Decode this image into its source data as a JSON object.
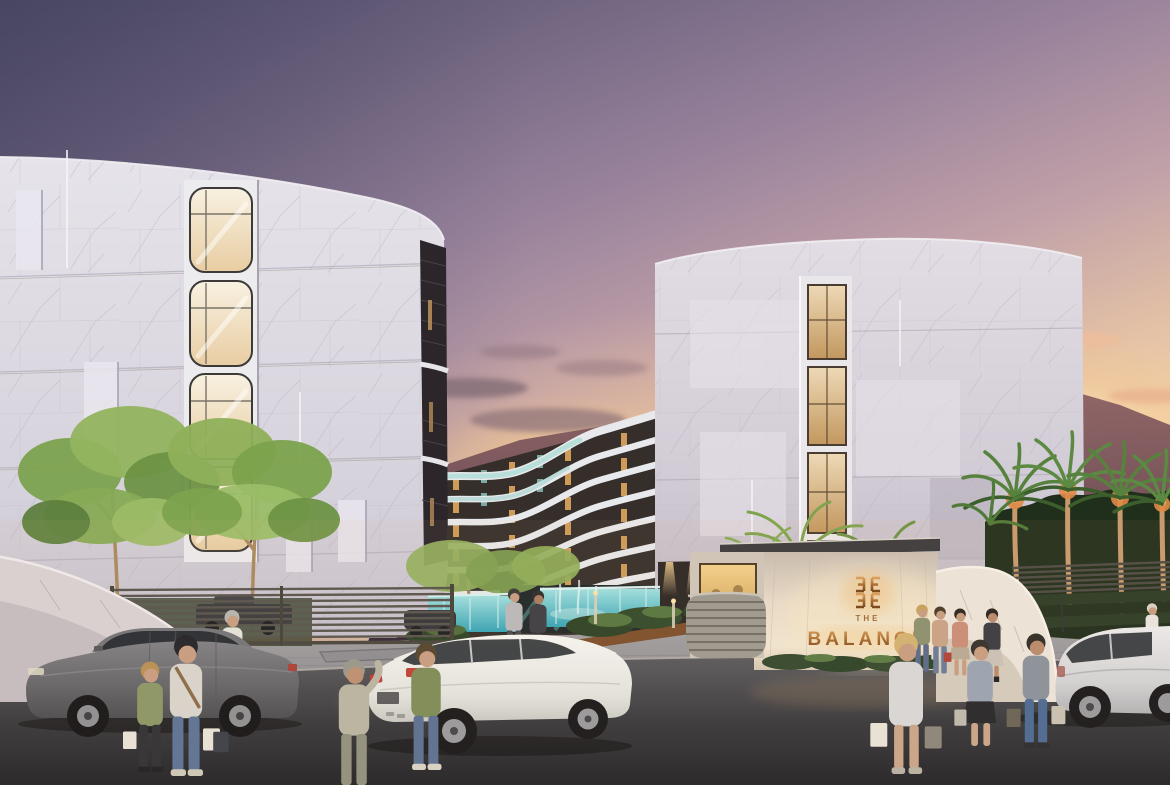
{
  "scene": {
    "title": "Twilight architectural rendering of The Balance condominium — marble buildings, pool courtyard, entrance gate sign, palm trees, cars and pedestrians",
    "signage": {
      "the_label": "THE",
      "name_label": "BALANCE"
    },
    "palette": {
      "sky_top": "#4d4b67",
      "sky_mauve": "#c0a0a8",
      "sky_peach": "#f6d9ae",
      "sunset_glow": "#ffe6b8",
      "mountain": "#5c4350",
      "marble": "#e2dfe6",
      "warm_window": "#ecd3a6",
      "band_white": "#e7e9ec",
      "pool_teal": "#52c0cc",
      "foliage": "#7fa050",
      "palm_backdrop": "#202e1c",
      "trunk_uplight": "#e08a46",
      "plaza": "#98969c",
      "road": "#2c2c31",
      "bronze_sign": "#a06a34",
      "car_grey": "#6e6e73",
      "car_white": "#f0f0ee",
      "car_silver": "#d6d6d9"
    },
    "elements": [
      "left marble tower with curved corner windows",
      "center wavy-band condominium wing",
      "right marble tower with vertical lit windows",
      "entrance gate wall with bronze logo",
      "guard booth with lit window",
      "swimming pool with glass edge and fountain",
      "uplit trees and palm trees",
      "mountain ridge at sunset",
      "grey sedan, white coupe, silver hatchback",
      "pedestrians with shopping bags"
    ]
  }
}
